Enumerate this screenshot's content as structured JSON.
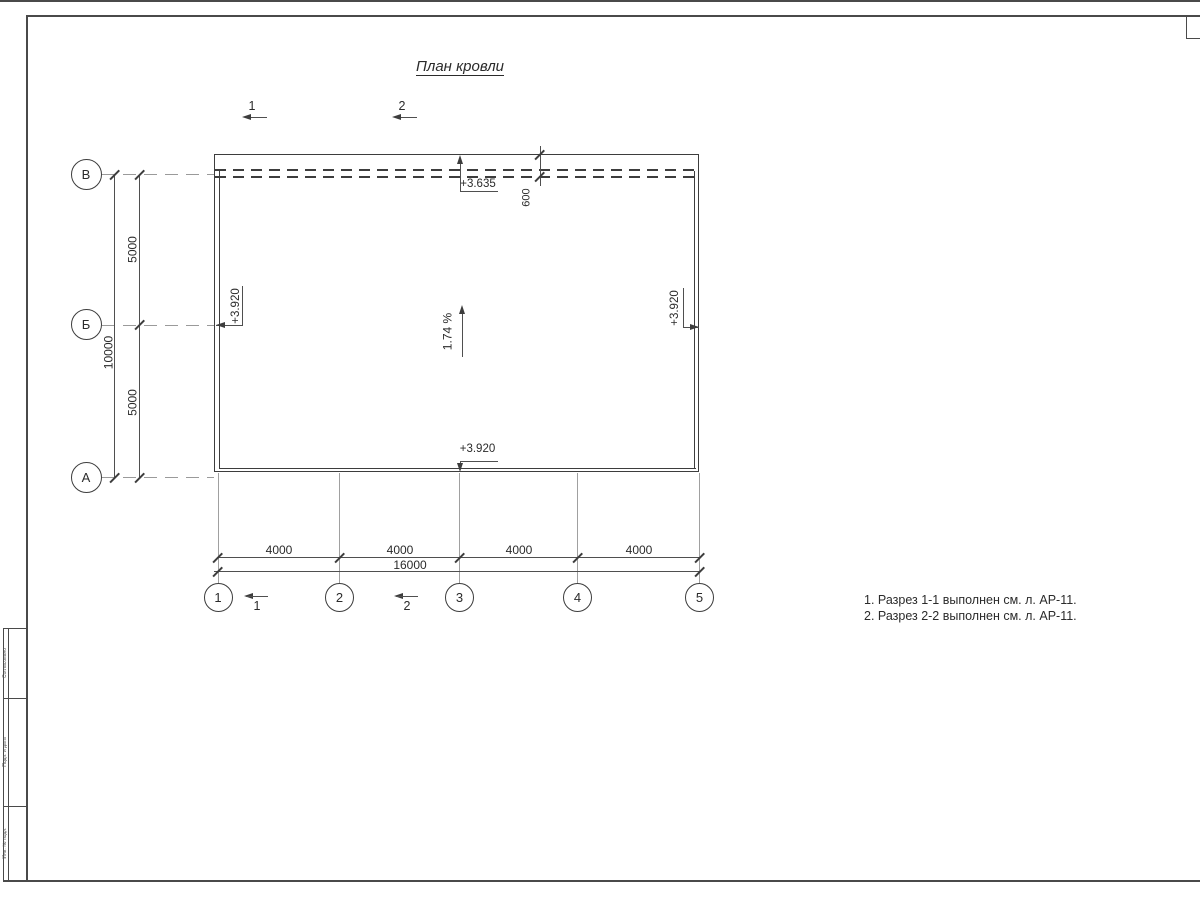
{
  "title": "План кровли",
  "axes": {
    "rows": [
      "В",
      "Б",
      "А"
    ],
    "cols": [
      "1",
      "2",
      "3",
      "4",
      "5"
    ]
  },
  "dims": {
    "total_v": "10000",
    "seg_v": [
      "5000",
      "5000"
    ],
    "seg_h": [
      "4000",
      "4000",
      "4000",
      "4000"
    ],
    "total_h": "16000",
    "parapet": "600"
  },
  "elev": {
    "ridge": "+3.635",
    "left": "+3.920",
    "right": "+3.920",
    "bottom": "+3.920"
  },
  "slope": "1.74 %",
  "sections": {
    "top": [
      "1",
      "2"
    ],
    "bottom": [
      "1",
      "2"
    ]
  },
  "notes": [
    "1. Разрез 1-1 выполнен см. л. АР-11.",
    "2. Разрез 2-2 выполнен см. л. АР-11."
  ],
  "stamp": {
    "box_top": "Согласовано",
    "box_mid": "Подп. и дата",
    "box_bottom": "Инв. № подл."
  },
  "colors": {
    "line": "#3d3d3d",
    "grid": "#9a9a9a",
    "text": "#2b2b2b"
  }
}
